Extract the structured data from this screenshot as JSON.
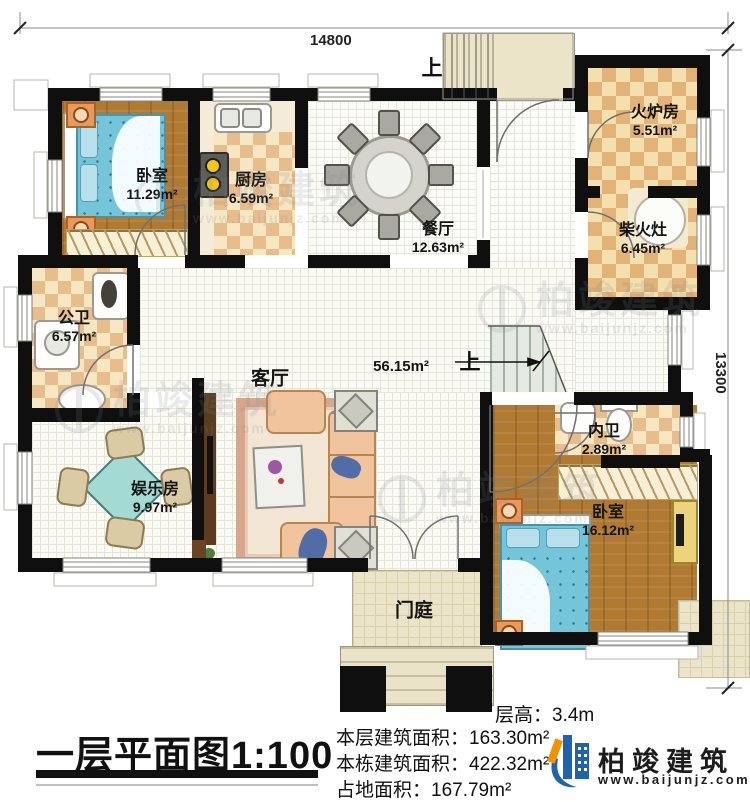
{
  "plan": {
    "title": "一层平面图",
    "scale": "1:100"
  },
  "dimensions": {
    "width_mm": "14800",
    "height_mm": "13300"
  },
  "stairs": {
    "up": "上"
  },
  "rooms": [
    {
      "id": "bedroom-1",
      "name": "卧室",
      "area": "11.29m²"
    },
    {
      "id": "kitchen",
      "name": "厨房",
      "area": "6.59m²"
    },
    {
      "id": "dining-room",
      "name": "餐厅",
      "area": "12.63m²"
    },
    {
      "id": "stove-room",
      "name": "火炉房",
      "area": "5.51m²"
    },
    {
      "id": "firewood-stove",
      "name": "柴火灶",
      "area": "6.45m²"
    },
    {
      "id": "public-bathroom",
      "name": "公卫",
      "area": "6.57m²"
    },
    {
      "id": "living-room",
      "name": "客厅",
      "area": "56.15m²"
    },
    {
      "id": "entertainment-room",
      "name": "娱乐房",
      "area": "9.97m²"
    },
    {
      "id": "ensuite-bathroom",
      "name": "内卫",
      "area": "2.89m²"
    },
    {
      "id": "bedroom-2",
      "name": "卧室",
      "area": "16.12m²"
    },
    {
      "id": "entry-porch",
      "name": "门庭",
      "area": ""
    }
  ],
  "info": {
    "floor_height": "层高：3.4m",
    "floor_area": "本层建筑面积：163.30m²",
    "building_area": "本栋建筑面积：422.32m²",
    "footprint_area": "占地面积：167.79m²"
  },
  "brand": {
    "name": "柏竣建筑",
    "url": "www.baijunjz.com"
  },
  "watermark": {
    "name": "柏竣建筑",
    "url": "www.baijunjz.com"
  },
  "colors": {
    "wall": "#0f0f0f",
    "brand_blue": "#1d63ad",
    "brand_orange": "#f29200"
  }
}
